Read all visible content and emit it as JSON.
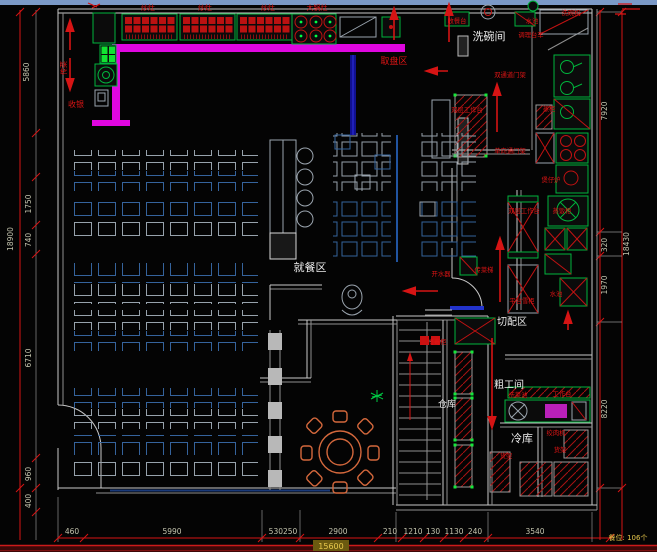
{
  "plan": {
    "areas": {
      "dishwash": "洗碗间",
      "dining": "就餐区",
      "cutting": "切配区",
      "roughwork": "粗工间",
      "warehouse": "仓库",
      "coldstore": "冷库"
    },
    "stations": {
      "stove": "炒灶",
      "big_wok": "大锅灶",
      "plate_pickup": "取盘区",
      "cashier": "收银",
      "food_pass": "传菜",
      "collect_table": "收餐台",
      "sink": "水池",
      "dishwasher": "洗碗机",
      "prep_trolley": "调理台车",
      "double_door_rack": "双通道门架",
      "double_worktable": "双层工作台",
      "steam_cabinet": "蒸柜",
      "oneway_door_rack": "单向通门架",
      "claypot_stove": "煲仔炉",
      "rice_steamer": "蒸饭柜",
      "water_boiler": "开水器",
      "food_lift": "传菜梯",
      "counter_freezer": "平台雪柜",
      "sterilizer": "消毒柜",
      "veg_sink": "洗菜池",
      "worktable": "工作台",
      "meat_grinder": "绞肉机",
      "shelf": "货架"
    },
    "dims": {
      "left": {
        "a": "5860",
        "b": "18900",
        "c": "1750",
        "d": "740",
        "e": "6710",
        "f": "960",
        "g": "400"
      },
      "right": {
        "a": "7920",
        "b": "320",
        "c": "18430",
        "d": "1970",
        "e": "8220"
      },
      "bottom": {
        "b1": "460",
        "b2": "5990",
        "b3": "530250",
        "b4": "2900",
        "b5": "210",
        "b6": "1210",
        "b7": "130",
        "b8": "1130",
        "b9": "240",
        "b10": "3540",
        "total": "15600"
      },
      "seats": "餐位: 106个"
    },
    "colors": {
      "pass_counter": "#e006e0",
      "equipment_green": "#00b53c",
      "annotation_red": "#d61414",
      "booth_blue": "#35639c"
    }
  }
}
